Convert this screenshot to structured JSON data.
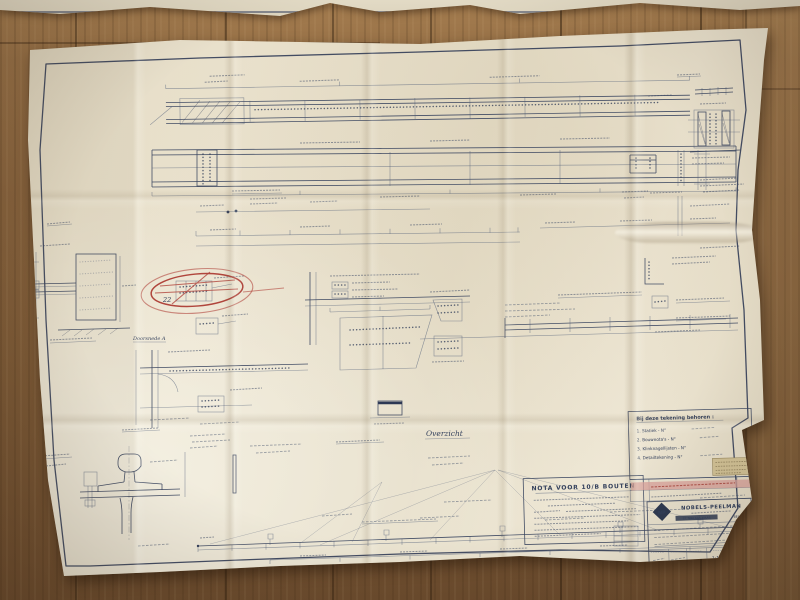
{
  "labels": {
    "overzicht": "Overzicht",
    "doorsnede_a": "Doorsnede A",
    "red_note": "22"
  },
  "nota_box": {
    "title": "NOTA VOOR 10/B BOUTEN"
  },
  "behoren_box": {
    "title": "Bij deze tekening behoren :",
    "items": [
      "1. Statiek  -  N°",
      "2. Bouwnota's  -  N°",
      "3. Klinknagellijsten  -  N°",
      "4. Detailtekening  -  N°"
    ]
  },
  "title_block": {
    "logo_text": "NP",
    "company": "NOBELS-PEELMAN",
    "location": "ST. NIKLAAS-WAAS",
    "country": "BELGIË",
    "scale": "1:10",
    "drawing_number": "11513-A1"
  },
  "colors": {
    "floor_wood": "#8a6743",
    "paper": "#e8e0cb",
    "ink_blue": "#3a4660",
    "red_pencil": "#b0453c",
    "highlight_pink": "#daa099",
    "note_tan": "#d3c397"
  }
}
